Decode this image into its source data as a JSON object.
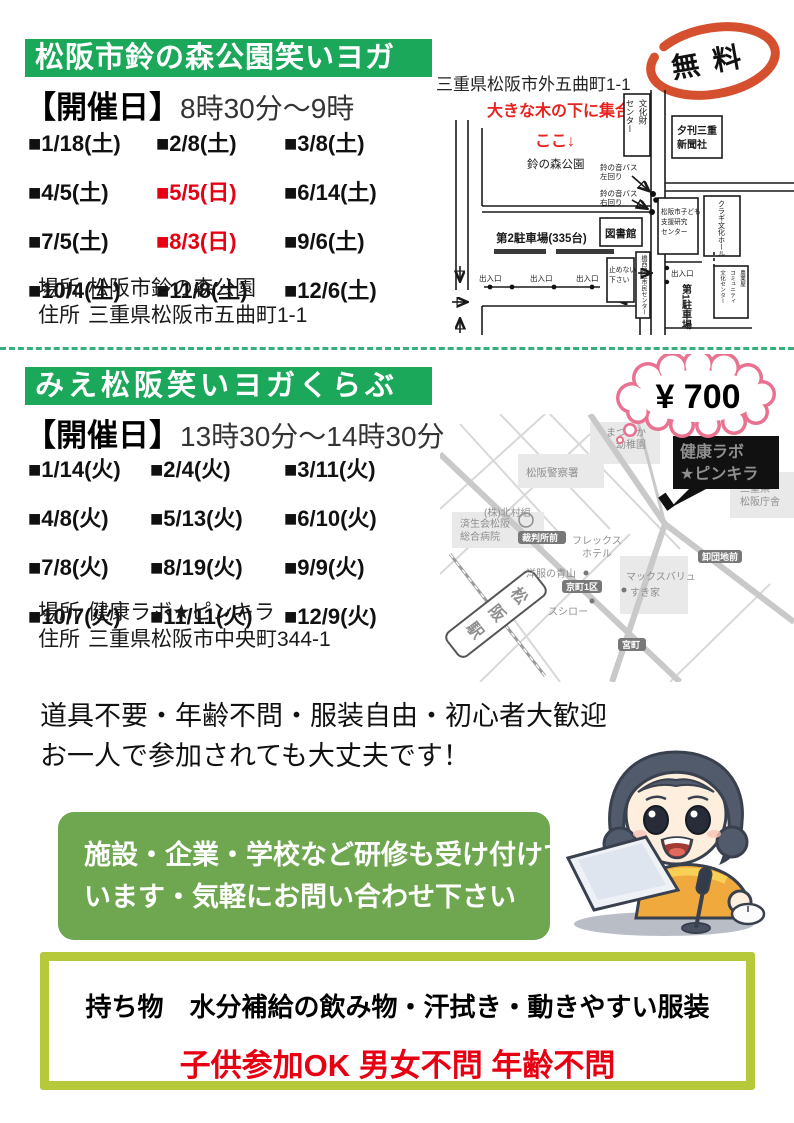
{
  "colors": {
    "band_green": "#1ca85a",
    "box_green": "#6fa750",
    "frame_yellow_green": "#b6c93b",
    "divider_teal": "#35af7d",
    "accent_red": "#e60012",
    "free_badge_red": "#d4502e",
    "bubble_pink": "#e8728f"
  },
  "section1": {
    "title": "松阪市鈴の森公園笑いヨガ",
    "schedule_label": "【開催日】",
    "schedule_time": "8時30分～9時",
    "dates": [
      {
        "text": "■1/18(土)",
        "red": false
      },
      {
        "text": "■2/8(土)",
        "red": false
      },
      {
        "text": "■3/8(土)",
        "red": false
      },
      {
        "text": "■4/5(土)",
        "red": false
      },
      {
        "text": "■5/5(日)",
        "red": true
      },
      {
        "text": "■6/14(土)",
        "red": false
      },
      {
        "text": "■7/5(土)",
        "red": false
      },
      {
        "text": "■8/3(日)",
        "red": true
      },
      {
        "text": "■9/6(土)",
        "red": false
      },
      {
        "text": "■10/4(土)",
        "red": false
      },
      {
        "text": "■11/8(土)",
        "red": false
      },
      {
        "text": "■12/6(土)",
        "red": false
      }
    ],
    "place_label": "場所",
    "place_value": "松阪市鈴の森公園",
    "address_label": "住所",
    "address_value": "三重県松阪市五曲町1-1",
    "fee_badge": "無料",
    "map": {
      "address_note": "三重県松阪市外五曲町1-1",
      "meet_line1": "大きな木の下に集合！",
      "meet_line2": "ここ↓",
      "park": "鈴の森公園",
      "bus_left_1": "鈴の音バス",
      "bus_left_2": "左回り",
      "bus_right_1": "鈴の音バス",
      "bus_right_2": "右回り",
      "bunkazai_1": "文化財",
      "bunkazai_2": "センター",
      "yukan_1": "夕刊三重",
      "yukan_2": "新聞社",
      "kuragi": "クラギ文化ホール",
      "kodomo_1": "松阪市子ども",
      "kodomo_2": "支援研究",
      "kodomo_3": "センター",
      "library": "図書館",
      "parking2": "第2駐車場(335台)",
      "no_parking_1": "止めないで",
      "no_parking_2": "下さい",
      "community": "橋西地区市民センター",
      "gate": "出入口",
      "parking1": "第1駐車場",
      "nogyoya_1": "農業屋",
      "nogyoya_2": "コミュニティ",
      "nogyoya_3": "文化センター"
    }
  },
  "section2": {
    "title": "みえ松阪笑いヨガくらぶ",
    "schedule_label": "【開催日】",
    "schedule_time": "13時30分～14時30分",
    "dates": [
      {
        "text": "■1/14(火)",
        "red": false
      },
      {
        "text": "■2/4(火)",
        "red": false
      },
      {
        "text": "■3/11(火)",
        "red": false
      },
      {
        "text": "■4/8(火)",
        "red": false
      },
      {
        "text": "■5/13(火)",
        "red": false
      },
      {
        "text": "■6/10(火)",
        "red": false
      },
      {
        "text": "■7/8(火)",
        "red": false
      },
      {
        "text": "■8/19(火)",
        "red": false
      },
      {
        "text": "■9/9(火)",
        "red": false
      },
      {
        "text": "■10/7(火)",
        "red": false
      },
      {
        "text": "■11/11(火)",
        "red": false
      },
      {
        "text": "■12/9(火)",
        "red": false
      }
    ],
    "place_label": "場所",
    "place_value": "健康ラボ★ピンキラ",
    "address_label": "住所",
    "address_value": "三重県松阪市中央町344-1",
    "fee_bubble": "¥ 700",
    "map": {
      "venue_1": "健康ラボ",
      "venue_2": "★ピンキラ",
      "kindergarten_1": "まつさか",
      "kindergarten_2": "幼稚園",
      "police": "松阪警察署",
      "kitamura": "(株)北村組",
      "prefoffice_1": "三重県",
      "prefoffice_2": "松阪庁舎",
      "hospital_1": "済生会松阪",
      "hospital_2": "総合病院",
      "saibansho": "裁判所前",
      "hotel_1": "フレックス",
      "hotel_2": "ホテル",
      "aoyama": "洋服の青山",
      "kyomachi": "京町1区",
      "sushiro": "スシロー",
      "maxvalu": "マックスバリュ",
      "sukiya": "すき家",
      "oroshi": "卸団地前",
      "miyamachi": "宮町",
      "station": "松阪駅"
    }
  },
  "notes": {
    "line1": "道具不要・年齢不問・服装自由・初心者大歓迎",
    "line2": "お一人で参加されても大丈夫です！"
  },
  "training_box": {
    "line1": "施設・企業・学校など研修も受け付けて",
    "line2": "います・気軽にお問い合わせ下さい"
  },
  "bring_box": {
    "items": "持ち物　水分補給の飲み物・汗拭き・動きやすい服装",
    "note": "子供参加OK 男女不問 年齢不問"
  }
}
